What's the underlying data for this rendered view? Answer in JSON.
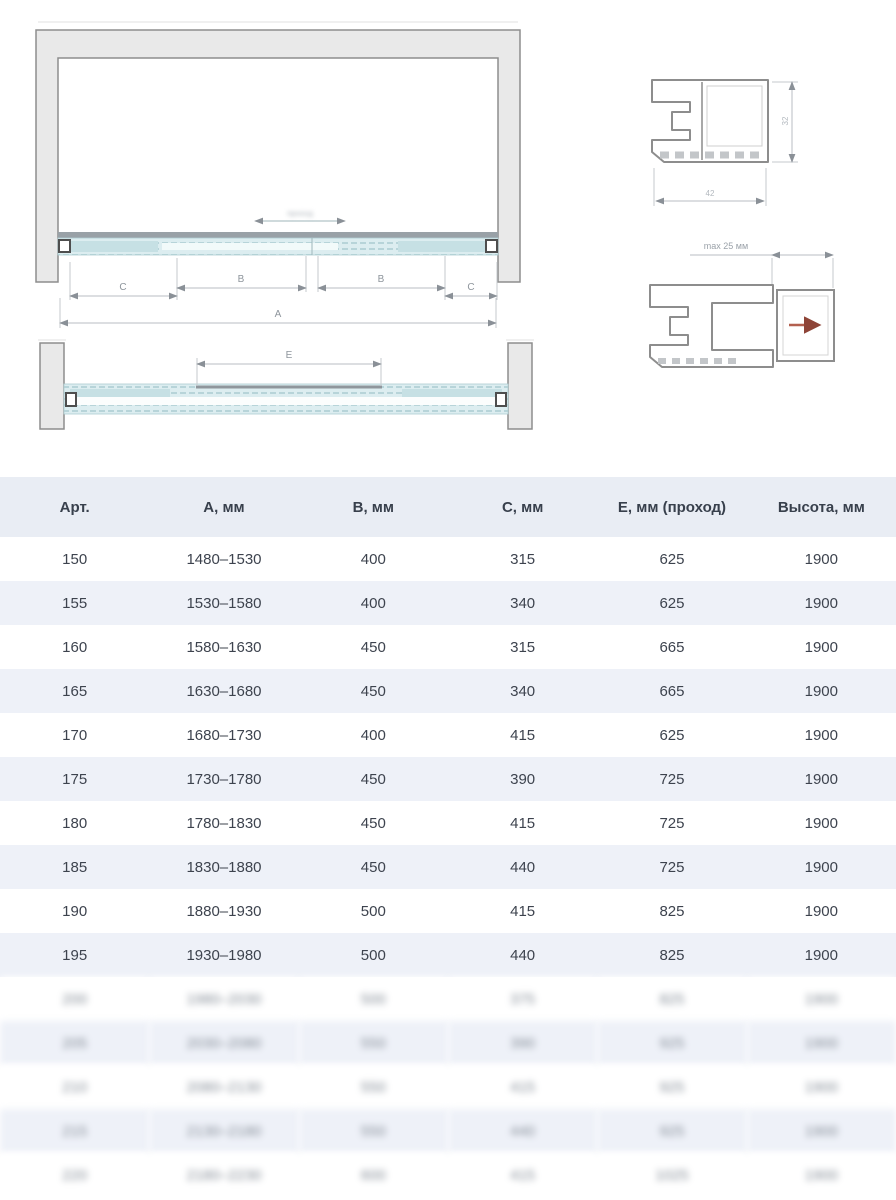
{
  "drawings": {
    "front_view": {
      "dim_a": "А",
      "dim_b": "В",
      "dim_c": "С",
      "obscured_label": "проход"
    },
    "top_view": {
      "dim_e": "Е"
    },
    "profile_main": {
      "height_dim": "32",
      "width_dim": "42"
    },
    "profile_adjustable": {
      "max_adjust": "max 25 мм"
    }
  },
  "colors": {
    "wall_fill": "#e9e9e9",
    "glass_fill": "#dcedf0",
    "glass_hatch": "#b7d4d9",
    "header_bg": "#e9edf4",
    "alt_row_bg": "#eef1f8",
    "accent_arrow": "#b3604f"
  },
  "table": {
    "headers": [
      "Арт.",
      "А, мм",
      "В, мм",
      "С, мм",
      "Е, мм (проход)",
      "Высота, мм"
    ],
    "rows": [
      {
        "obscured": false,
        "cells": [
          "150",
          "1480–1530",
          "400",
          "315",
          "625",
          "1900"
        ]
      },
      {
        "obscured": false,
        "cells": [
          "155",
          "1530–1580",
          "400",
          "340",
          "625",
          "1900"
        ]
      },
      {
        "obscured": false,
        "cells": [
          "160",
          "1580–1630",
          "450",
          "315",
          "665",
          "1900"
        ]
      },
      {
        "obscured": false,
        "cells": [
          "165",
          "1630–1680",
          "450",
          "340",
          "665",
          "1900"
        ]
      },
      {
        "obscured": false,
        "cells": [
          "170",
          "1680–1730",
          "400",
          "415",
          "625",
          "1900"
        ]
      },
      {
        "obscured": false,
        "cells": [
          "175",
          "1730–1780",
          "450",
          "390",
          "725",
          "1900"
        ]
      },
      {
        "obscured": false,
        "cells": [
          "180",
          "1780–1830",
          "450",
          "415",
          "725",
          "1900"
        ]
      },
      {
        "obscured": false,
        "cells": [
          "185",
          "1830–1880",
          "450",
          "440",
          "725",
          "1900"
        ]
      },
      {
        "obscured": false,
        "cells": [
          "190",
          "1880–1930",
          "500",
          "415",
          "825",
          "1900"
        ]
      },
      {
        "obscured": false,
        "cells": [
          "195",
          "1930–1980",
          "500",
          "440",
          "825",
          "1900"
        ]
      },
      {
        "obscured": true,
        "cells": [
          "200",
          "1980–2030",
          "500",
          "375",
          "825",
          "1900"
        ]
      },
      {
        "obscured": true,
        "cells": [
          "205",
          "2030–2080",
          "550",
          "390",
          "925",
          "1900"
        ]
      },
      {
        "obscured": true,
        "cells": [
          "210",
          "2080–2130",
          "550",
          "415",
          "925",
          "1900"
        ]
      },
      {
        "obscured": true,
        "cells": [
          "215",
          "2130–2180",
          "550",
          "440",
          "925",
          "1900"
        ]
      },
      {
        "obscured": true,
        "cells": [
          "220",
          "2180–2230",
          "600",
          "415",
          "1025",
          "1900"
        ]
      }
    ]
  }
}
